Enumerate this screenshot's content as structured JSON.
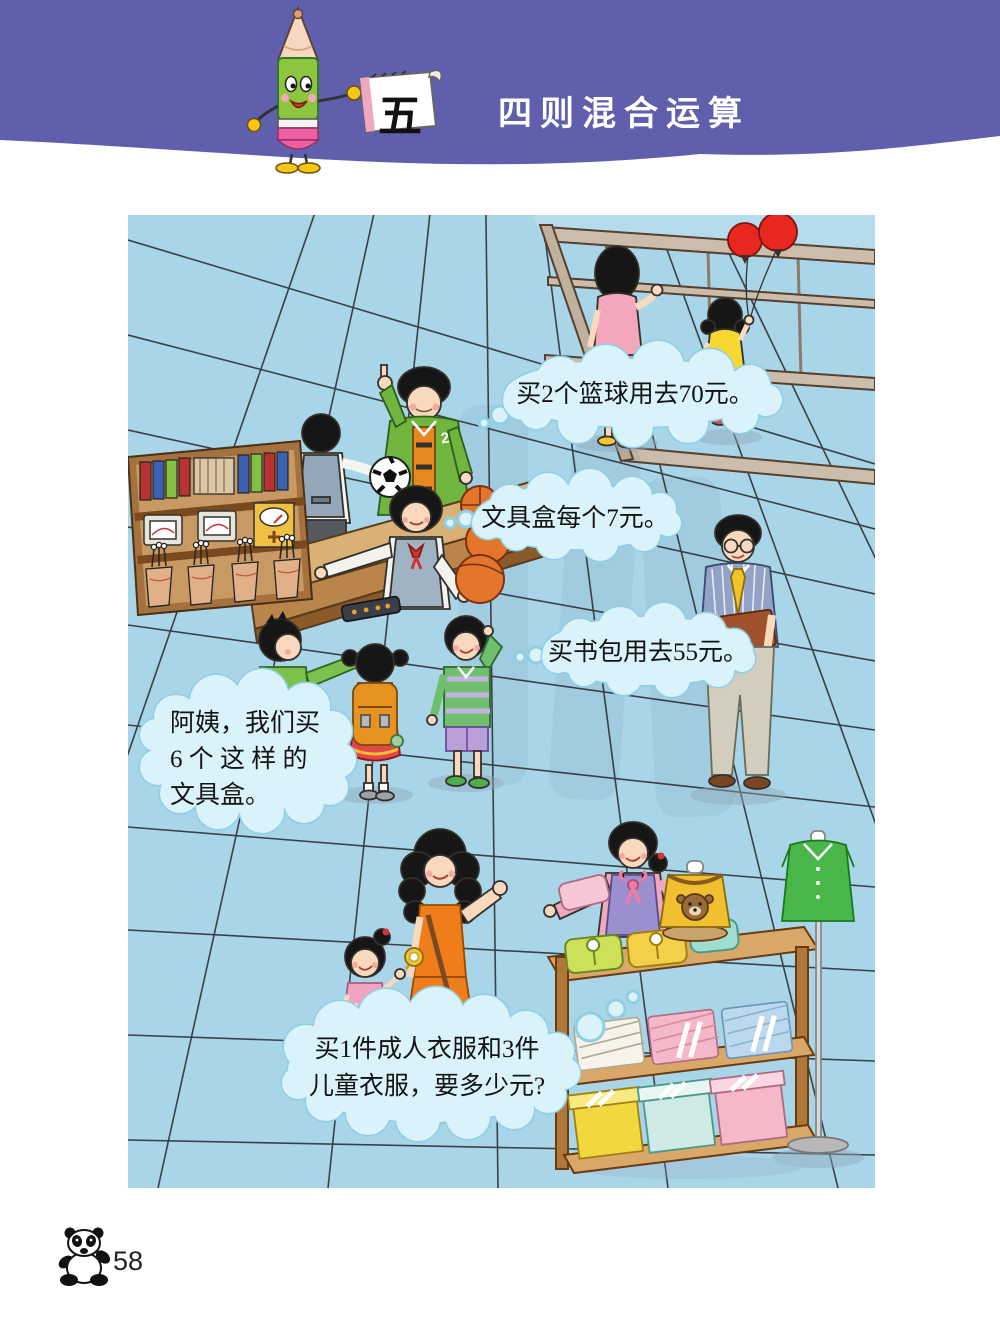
{
  "header": {
    "unit_number": "五",
    "title": "四则混合运算"
  },
  "scene": {
    "bubbles": {
      "basketball": {
        "text": "买2个篮球用去70元。"
      },
      "pencil_box_price": {
        "text": "文具盒每个7元。"
      },
      "schoolbag": {
        "text": "买书包用去55元。"
      },
      "buy_pencil_boxes": {
        "lines": [
          "阿姨，我们买",
          "6 个 这 样 的",
          "文具盒。"
        ]
      },
      "clothes_question": {
        "lines": [
          "买1件成人衣服和3件",
          "儿童衣服，要多少元?"
        ]
      }
    },
    "jersey_number": "2"
  },
  "footer": {
    "page_number": "58"
  },
  "colors": {
    "header_band": "#605fae",
    "floor_blue": "#a9d5e9",
    "bubble_fill": "#daf2fa",
    "bubble_edge": "#8fcfe4",
    "balloon_red": "#e8281e",
    "jacket_green": "#6fb53e",
    "dress_orange": "#ef7d1a",
    "shelf_wood": "#d9a868"
  }
}
